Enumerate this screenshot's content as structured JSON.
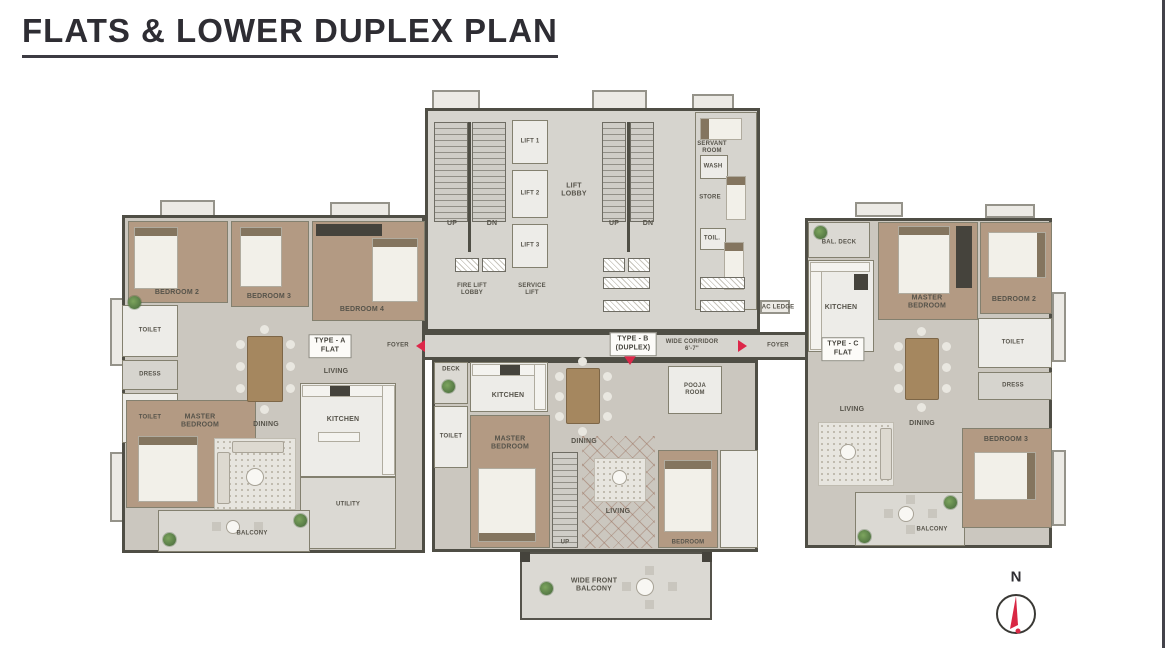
{
  "title": "FLATS & LOWER DUPLEX PLAN",
  "compass": {
    "north": "N"
  },
  "core": {
    "up": "UP",
    "dn": "DN",
    "lifts": [
      "LIFT 1",
      "LIFT 2",
      "LIFT 3"
    ],
    "lift_lobby": "LIFT\nLOBBY",
    "fire_lift_lobby": "FIRE LIFT\nLOBBY",
    "service_lift": "SERVICE\nLIFT",
    "servant_room": "SERVANT\nROOM",
    "wash": "WASH",
    "store": "STORE",
    "toilet": "TOIL.",
    "ac_ledge": "AC LEDGE"
  },
  "corridor": {
    "foyer": "FOYER",
    "wide_corridor": "WIDE CORRIDOR\n6'-7\"",
    "type_a": "TYPE - A\nFLAT",
    "type_b": "TYPE - B\n(DUPLEX)",
    "type_c": "TYPE - C\nFLAT"
  },
  "flat_a": {
    "bedroom2": "BEDROOM 2",
    "bedroom3": "BEDROOM 3",
    "bedroom4": "BEDROOM 4",
    "master_bedroom": "MASTER\nBEDROOM",
    "toilet": "TOILET",
    "dress": "DRESS",
    "dining": "DINING",
    "living": "LIVING",
    "kitchen": "KITCHEN",
    "utility": "UTILITY",
    "balcony": "BALCONY"
  },
  "flat_b": {
    "deck": "DECK",
    "kitchen": "KITCHEN",
    "dining": "DINING",
    "pooja_room": "POOJA\nROOM",
    "master_bedroom": "MASTER\nBEDROOM",
    "toilet": "TOILET",
    "living": "LIVING",
    "bedroom": "BEDROOM",
    "up": "UP",
    "front_balcony": "WIDE FRONT\nBALCONY"
  },
  "flat_c": {
    "bal_deck": "BAL. DECK",
    "kitchen": "KITCHEN",
    "master_bedroom": "MASTER\nBEDROOM",
    "bedroom2": "BEDROOM 2",
    "bedroom3": "BEDROOM 3",
    "dining": "DINING",
    "toilet": "TOILET",
    "dress": "DRESS",
    "living": "LIVING",
    "balcony": "BALCONY"
  }
}
